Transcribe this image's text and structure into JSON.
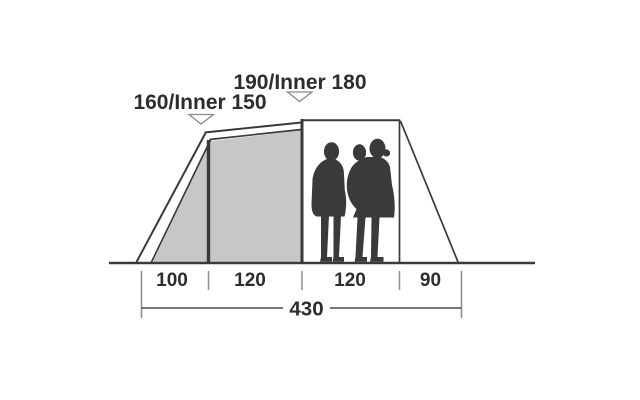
{
  "diagram": {
    "type": "tent-side-profile-dimension-diagram",
    "height_labels": {
      "porch": "160/Inner 150",
      "main": "190/Inner 180"
    },
    "dimensions": {
      "segments": [
        "100",
        "120",
        "120",
        "90"
      ],
      "total": "430"
    },
    "silhouette": "two-adults-one-carrying-child",
    "colors": {
      "line": "#3a3a3a",
      "canopy_fill": "#c6c7c6",
      "silhouette": "#3a3a3a",
      "tick": "#8f8f8f",
      "dim_line": "#4a4a4a",
      "text": "#2d2d2d",
      "marker_stroke": "#8a8a8a",
      "marker_fill": "#ffffff"
    }
  }
}
